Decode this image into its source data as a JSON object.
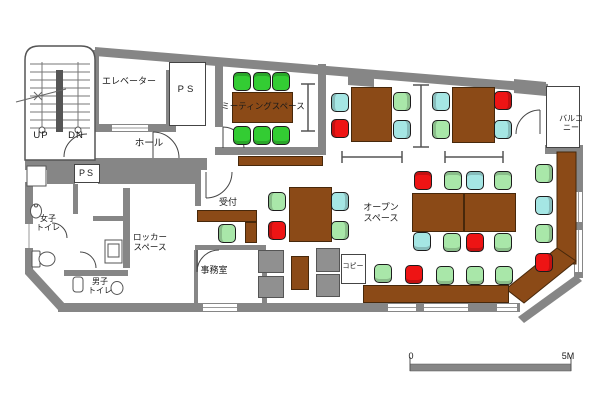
{
  "title": "office-floor-plan",
  "colors": {
    "wall": "#868686",
    "table_brown": "#8b4a17",
    "chair_bright_green": "#33cc33",
    "chair_light_green": "#a9e7a9",
    "chair_cyan": "#a5e6e4",
    "chair_red": "#ee1414"
  },
  "labels": [
    {
      "name": "elevator",
      "text": "エレベーター",
      "x": 129,
      "y": 76,
      "fs": 9
    },
    {
      "name": "ps-upper",
      "text": "PS",
      "x": 187,
      "y": 84,
      "fs": 9.5,
      "ls": 3
    },
    {
      "name": "hall",
      "text": "ホール",
      "x": 149,
      "y": 138,
      "fs": 9.5
    },
    {
      "name": "stairs-up",
      "text": "UP",
      "x": 41,
      "y": 130,
      "fs": 9.5,
      "ls": 1
    },
    {
      "name": "stairs-down",
      "text": "DN",
      "x": 76,
      "y": 130,
      "fs": 9.5,
      "ls": 1
    },
    {
      "name": "ps-lower",
      "text": "PS",
      "x": 87,
      "y": 168,
      "fs": 9,
      "ls": 2
    },
    {
      "name": "meeting-space",
      "text": "ミーティングスペース",
      "x": 263,
      "y": 101,
      "fs": 8.5
    },
    {
      "name": "balcony",
      "text": "バルコニー",
      "x": 571,
      "y": 114,
      "fs": 8
    },
    {
      "name": "womens-toilet",
      "text": "女子\nトイレ",
      "x": 48,
      "y": 214,
      "fs": 8
    },
    {
      "name": "mens-toilet",
      "text": "男子\nトイレ",
      "x": 100,
      "y": 277,
      "fs": 8
    },
    {
      "name": "locker-space",
      "text": "ロッカー\nスペース",
      "x": 150,
      "y": 232,
      "fs": 8.5
    },
    {
      "name": "reception",
      "text": "受付",
      "x": 228,
      "y": 197,
      "fs": 9
    },
    {
      "name": "office-room",
      "text": "事務室",
      "x": 214,
      "y": 265,
      "fs": 9
    },
    {
      "name": "open-space",
      "text": "オープン\nスペース",
      "x": 381,
      "y": 202,
      "fs": 9
    },
    {
      "name": "copy",
      "text": "コピー",
      "x": 353,
      "y": 263,
      "fs": 7
    },
    {
      "name": "scale-zero",
      "text": "0",
      "x": 411,
      "y": 351,
      "fs": 9
    },
    {
      "name": "scale-5m",
      "text": "5M",
      "x": 568,
      "y": 351,
      "fs": 9
    }
  ],
  "boxes": [
    {
      "name": "ps-room-upper",
      "x": 169,
      "y": 62,
      "w": 37,
      "h": 64
    },
    {
      "name": "ps-box-lower",
      "x": 74,
      "y": 164,
      "w": 26,
      "h": 19
    },
    {
      "name": "copy-machine",
      "x": 341,
      "y": 254,
      "w": 25,
      "h": 30
    },
    {
      "name": "balcony-area",
      "x": 546,
      "y": 86,
      "w": 34,
      "h": 62
    }
  ],
  "furniture": {
    "tables": [
      {
        "name": "meeting-table",
        "x": 232,
        "y": 92,
        "w": 61,
        "h": 31
      },
      {
        "name": "table-a",
        "x": 351,
        "y": 87,
        "w": 41,
        "h": 55
      },
      {
        "name": "table-b",
        "x": 452,
        "y": 87,
        "w": 43,
        "h": 56
      },
      {
        "name": "center-table",
        "x": 289,
        "y": 187,
        "w": 43,
        "h": 55
      },
      {
        "name": "open-space-table-left",
        "x": 412,
        "y": 193,
        "w": 52,
        "h": 39
      },
      {
        "name": "open-space-table-right",
        "x": 464,
        "y": 193,
        "w": 52,
        "h": 39
      },
      {
        "name": "reception-counter-h",
        "x": 197,
        "y": 210,
        "w": 60,
        "h": 12
      },
      {
        "name": "reception-counter-v",
        "x": 245,
        "y": 222,
        "w": 12,
        "h": 21
      },
      {
        "name": "meeting-shelf",
        "x": 238,
        "y": 156,
        "w": 85,
        "h": 10
      },
      {
        "name": "small-cabinet",
        "x": 291,
        "y": 256,
        "w": 18,
        "h": 34
      },
      {
        "name": "bottom-counter",
        "x": 363,
        "y": 285,
        "w": 146,
        "h": 18
      }
    ],
    "cabinets": [
      {
        "x": 258,
        "y": 250,
        "w": 26,
        "h": 23
      },
      {
        "x": 258,
        "y": 276,
        "w": 26,
        "h": 22
      },
      {
        "x": 316,
        "y": 248,
        "w": 24,
        "h": 24
      },
      {
        "x": 316,
        "y": 274,
        "w": 24,
        "h": 23
      }
    ],
    "chairs": [
      {
        "x": 233,
        "y": 72,
        "c": "G",
        "b": "t"
      },
      {
        "x": 253,
        "y": 72,
        "c": "G",
        "b": "t"
      },
      {
        "x": 272,
        "y": 72,
        "c": "G",
        "b": "t"
      },
      {
        "x": 233,
        "y": 126,
        "c": "G",
        "b": "b"
      },
      {
        "x": 253,
        "y": 126,
        "c": "G",
        "b": "b"
      },
      {
        "x": 272,
        "y": 126,
        "c": "G",
        "b": "b"
      },
      {
        "x": 331,
        "y": 93,
        "c": "c",
        "b": "l"
      },
      {
        "x": 331,
        "y": 119,
        "c": "r",
        "b": "l"
      },
      {
        "x": 393,
        "y": 92,
        "c": "g",
        "b": "r"
      },
      {
        "x": 393,
        "y": 120,
        "c": "c",
        "b": "r"
      },
      {
        "x": 432,
        "y": 92,
        "c": "c",
        "b": "l"
      },
      {
        "x": 432,
        "y": 120,
        "c": "g",
        "b": "l"
      },
      {
        "x": 494,
        "y": 91,
        "c": "r",
        "b": "r"
      },
      {
        "x": 494,
        "y": 120,
        "c": "c",
        "b": "r"
      },
      {
        "x": 268,
        "y": 192,
        "c": "g",
        "b": "l"
      },
      {
        "x": 268,
        "y": 221,
        "c": "r",
        "b": "l"
      },
      {
        "x": 331,
        "y": 192,
        "c": "c",
        "b": "r"
      },
      {
        "x": 331,
        "y": 221,
        "c": "g",
        "b": "r"
      },
      {
        "x": 218,
        "y": 224,
        "c": "g",
        "b": "l"
      },
      {
        "x": 414,
        "y": 171,
        "c": "r",
        "b": "t"
      },
      {
        "x": 444,
        "y": 171,
        "c": "g",
        "b": "t"
      },
      {
        "x": 466,
        "y": 171,
        "c": "c",
        "b": "t"
      },
      {
        "x": 494,
        "y": 171,
        "c": "g",
        "b": "t"
      },
      {
        "x": 413,
        "y": 232,
        "c": "c",
        "b": "b"
      },
      {
        "x": 443,
        "y": 233,
        "c": "g",
        "b": "b"
      },
      {
        "x": 466,
        "y": 233,
        "c": "r",
        "b": "b"
      },
      {
        "x": 494,
        "y": 233,
        "c": "g",
        "b": "b"
      },
      {
        "x": 535,
        "y": 164,
        "c": "g",
        "b": "r"
      },
      {
        "x": 535,
        "y": 196,
        "c": "c",
        "b": "r"
      },
      {
        "x": 535,
        "y": 224,
        "c": "g",
        "b": "r"
      },
      {
        "x": 535,
        "y": 253,
        "c": "r",
        "b": "r"
      },
      {
        "x": 374,
        "y": 264,
        "c": "g",
        "b": "b"
      },
      {
        "x": 405,
        "y": 265,
        "c": "r",
        "b": "b"
      },
      {
        "x": 436,
        "y": 266,
        "c": "g",
        "b": "b"
      },
      {
        "x": 466,
        "y": 266,
        "c": "g",
        "b": "b"
      },
      {
        "x": 495,
        "y": 266,
        "c": "g",
        "b": "b"
      }
    ]
  },
  "scalebar": {
    "start_label": "0",
    "end_label": "5M"
  }
}
